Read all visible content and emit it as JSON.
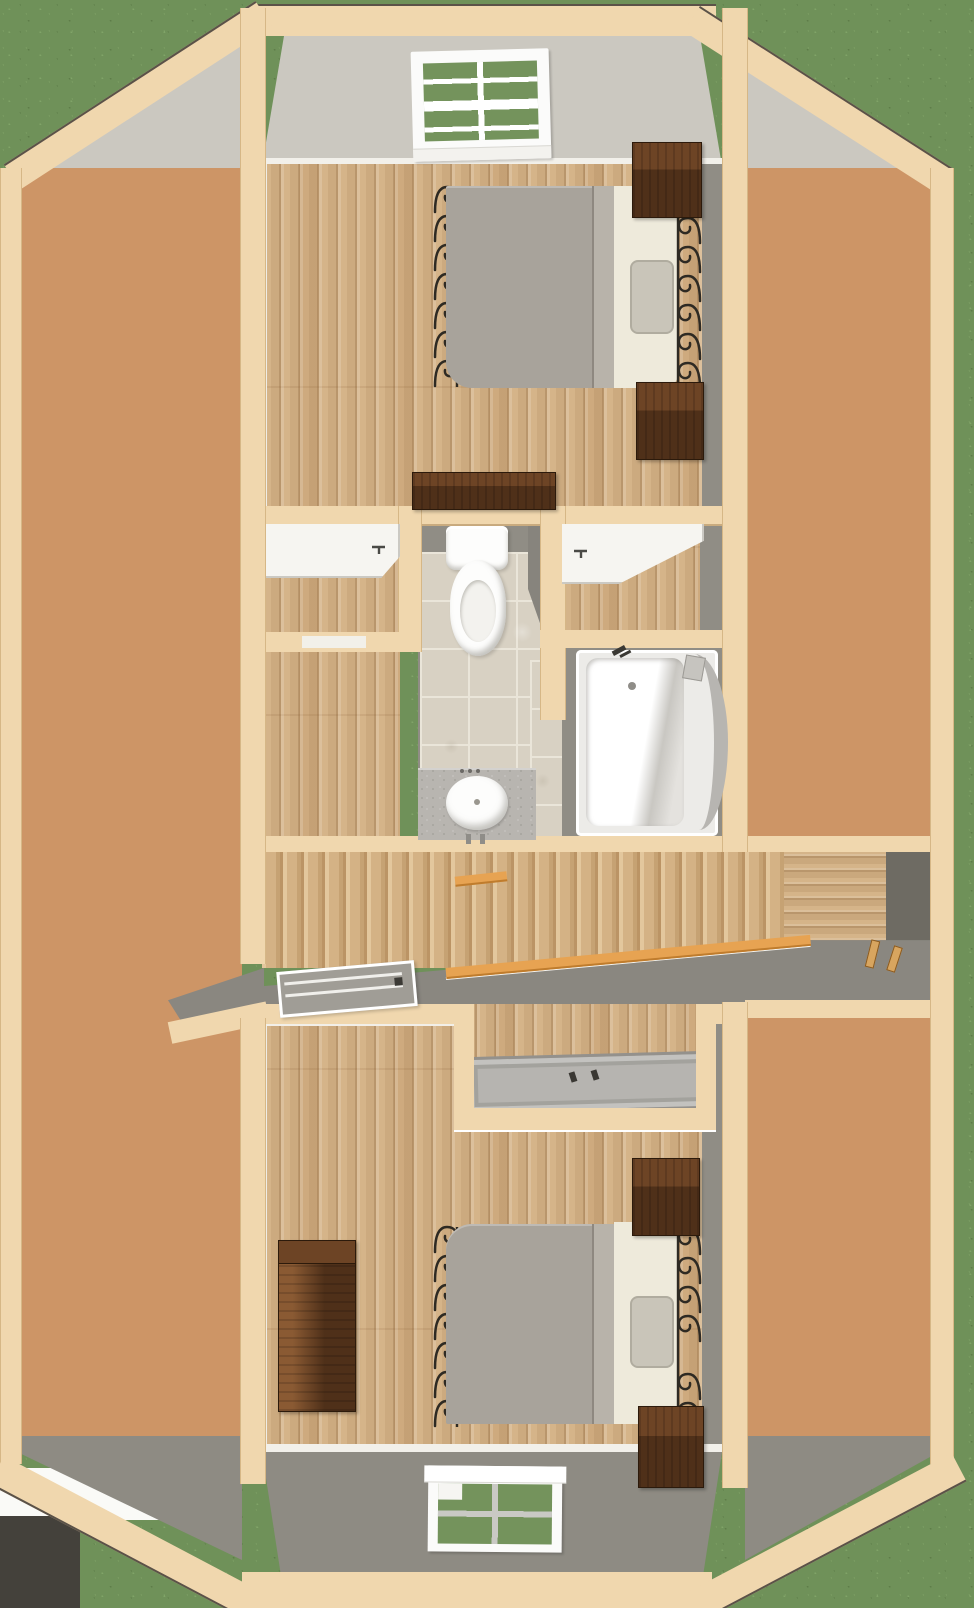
{
  "meta": {
    "type": "3d-floor-plan-overhead-render",
    "floor": "upper-floor",
    "visible_text": "none"
  },
  "colors": {
    "grass": "#6f9159",
    "grassLight": "#80a468",
    "grassDark": "#5e7d49",
    "whitePatch": "#fafaf7",
    "asphalt": "#44413b",
    "cap": "#f0d7ae",
    "capEdge": "#d6b786",
    "outline": "#5b5248",
    "roofLight": "#cbc8c0",
    "roofDark": "#8e8b83",
    "wallGray": "#908d85",
    "wallDarker": "#6e6b63",
    "osb": "#cd9566",
    "osbLight": "#eccb9f",
    "osbPale": "#f3ddb8",
    "osbMid": "#b5753e",
    "osbDeep": "#a05e2c",
    "wood": "#d5b489",
    "woodSeam": "#b8905f",
    "woodHi": "#e3c79d",
    "stairWood": "#d4b285",
    "stairSeam": "#bb9465",
    "trim": "#f2f0ea",
    "tile": "#d8d1c3",
    "tileGrout": "#eae5d9",
    "counter": "#b8b5b0",
    "counterDot": "#82807a",
    "fixture": "#fdfdfc",
    "fixtureShade": "#d8d7d3",
    "duvet": "#a8a39b",
    "duvetFold": "#b8b3aa",
    "sheet": "#eeeadb",
    "pillow": "#c9c5b9",
    "pillowEdge": "#b0ac9f",
    "iron": "#2e2a23",
    "furnDark": "#4f3019",
    "furnMid": "#6d4425",
    "furnLight": "#8a5a33",
    "rail": "#e7a352",
    "railEdge": "#bf7c2d",
    "pan": "#b6b4b0",
    "panEdge": "#94918c",
    "glass": "#74935c"
  },
  "scene": {
    "surroundings": [
      "grass-lawn",
      "dark-driveway-patch-bottom-left",
      "white-foundation-patch-bottom-left"
    ],
    "structure": {
      "roof_trim": "tan-wood-cap-octagon",
      "roof_slopes": [
        "top-gable-slope-light-gray",
        "bottom-gable-slope-dark-gray"
      ],
      "side_attics": [
        "left-osb-decking",
        "right-osb-decking"
      ]
    },
    "rooms": {
      "bedroom_top": {
        "window": {
          "location": "top-gable",
          "panes": 8
        },
        "furniture": [
          "iron-frame-bed",
          "nightstand",
          "nightstand",
          "storage-chest"
        ],
        "bedding": {
          "duvet": "gray",
          "sheet": "cream",
          "pillow": "gray"
        }
      },
      "bathroom": {
        "floor": "stone-tile",
        "fixtures": [
          "toilet",
          "vanity-sink",
          "bathtub"
        ],
        "closets": [
          "left-closet-shelf-and-rod",
          "right-closet-shelf-and-rod"
        ]
      },
      "stairwell": {
        "elements": [
          "stair-treads",
          "orange-wood-handrail",
          "gray-landing",
          "skylight-window",
          "balusters"
        ]
      },
      "shower_alcove": {
        "fixtures": [
          "shower-pan-two-handles"
        ]
      },
      "bedroom_bottom": {
        "window": {
          "location": "bottom-gable",
          "panes": 4
        },
        "furniture": [
          "iron-frame-bed",
          "nightstand",
          "nightstand",
          "tall-dresser"
        ],
        "bedding": {
          "duvet": "gray",
          "sheet": "cream",
          "pillow": "gray"
        }
      }
    }
  }
}
